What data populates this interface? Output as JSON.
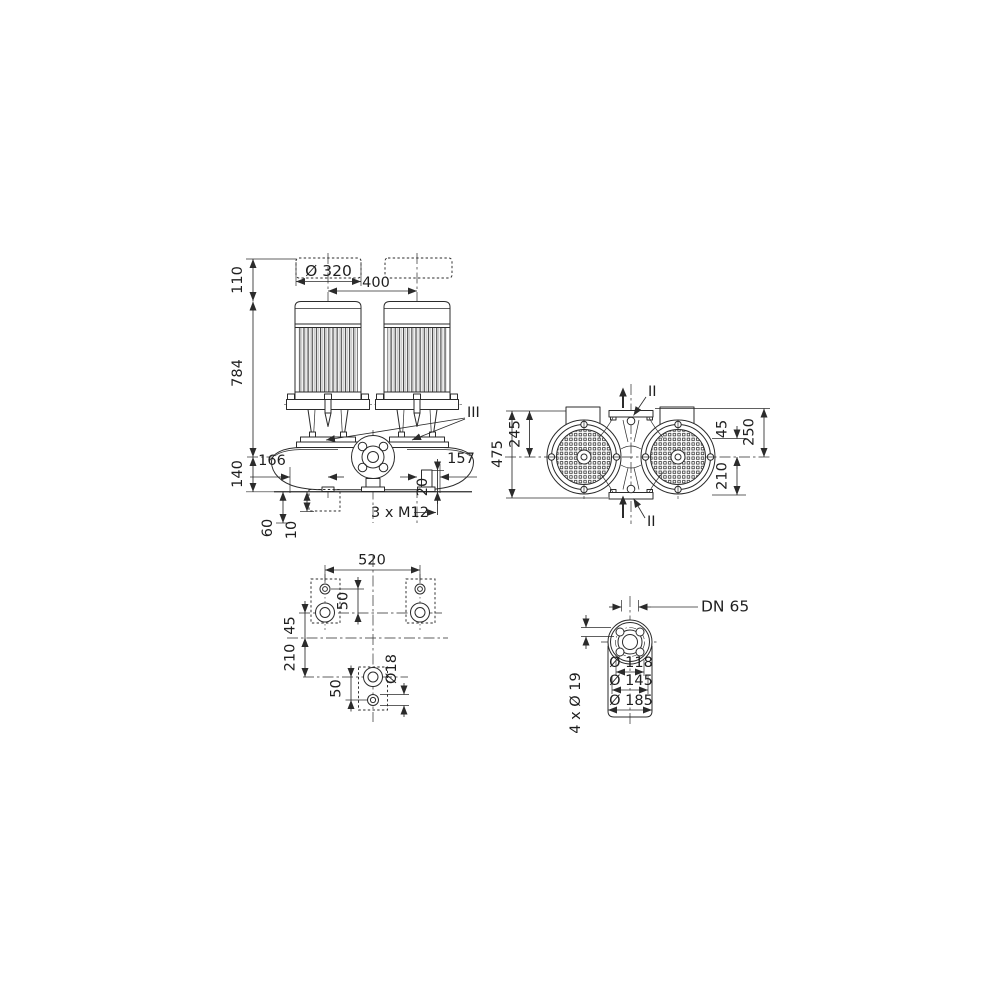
{
  "meta": {
    "type": "pump dimensional drawing, four orthographic views",
    "background": "#ffffff",
    "line_color": "#2b2b2b",
    "text_color": "#1f1f1f"
  },
  "front_view": {
    "d110": "110",
    "d320": "Ø 320",
    "d400": "400",
    "d784": "784",
    "d140": "140",
    "d166": "166",
    "d157": "157",
    "d20": "20",
    "bolt_note": "3 x M12",
    "d60": "60",
    "d10": "10",
    "callout": "III"
  },
  "plan_view": {
    "d475": "475",
    "d245": "245",
    "d45": "45",
    "d250": "250",
    "d210": "210",
    "callout_top": "II",
    "callout_bottom": "II"
  },
  "foundation_view": {
    "d520": "520",
    "d50_upper": "50",
    "d45": "45",
    "d210": "210",
    "d50_lower": "50",
    "d_hole": "Ø18"
  },
  "flange_view": {
    "nominal": "DN 65",
    "d118": "Ø 118",
    "d145": "Ø 145",
    "d185": "Ø 185",
    "bolt_holes": "4 x Ø 19"
  }
}
